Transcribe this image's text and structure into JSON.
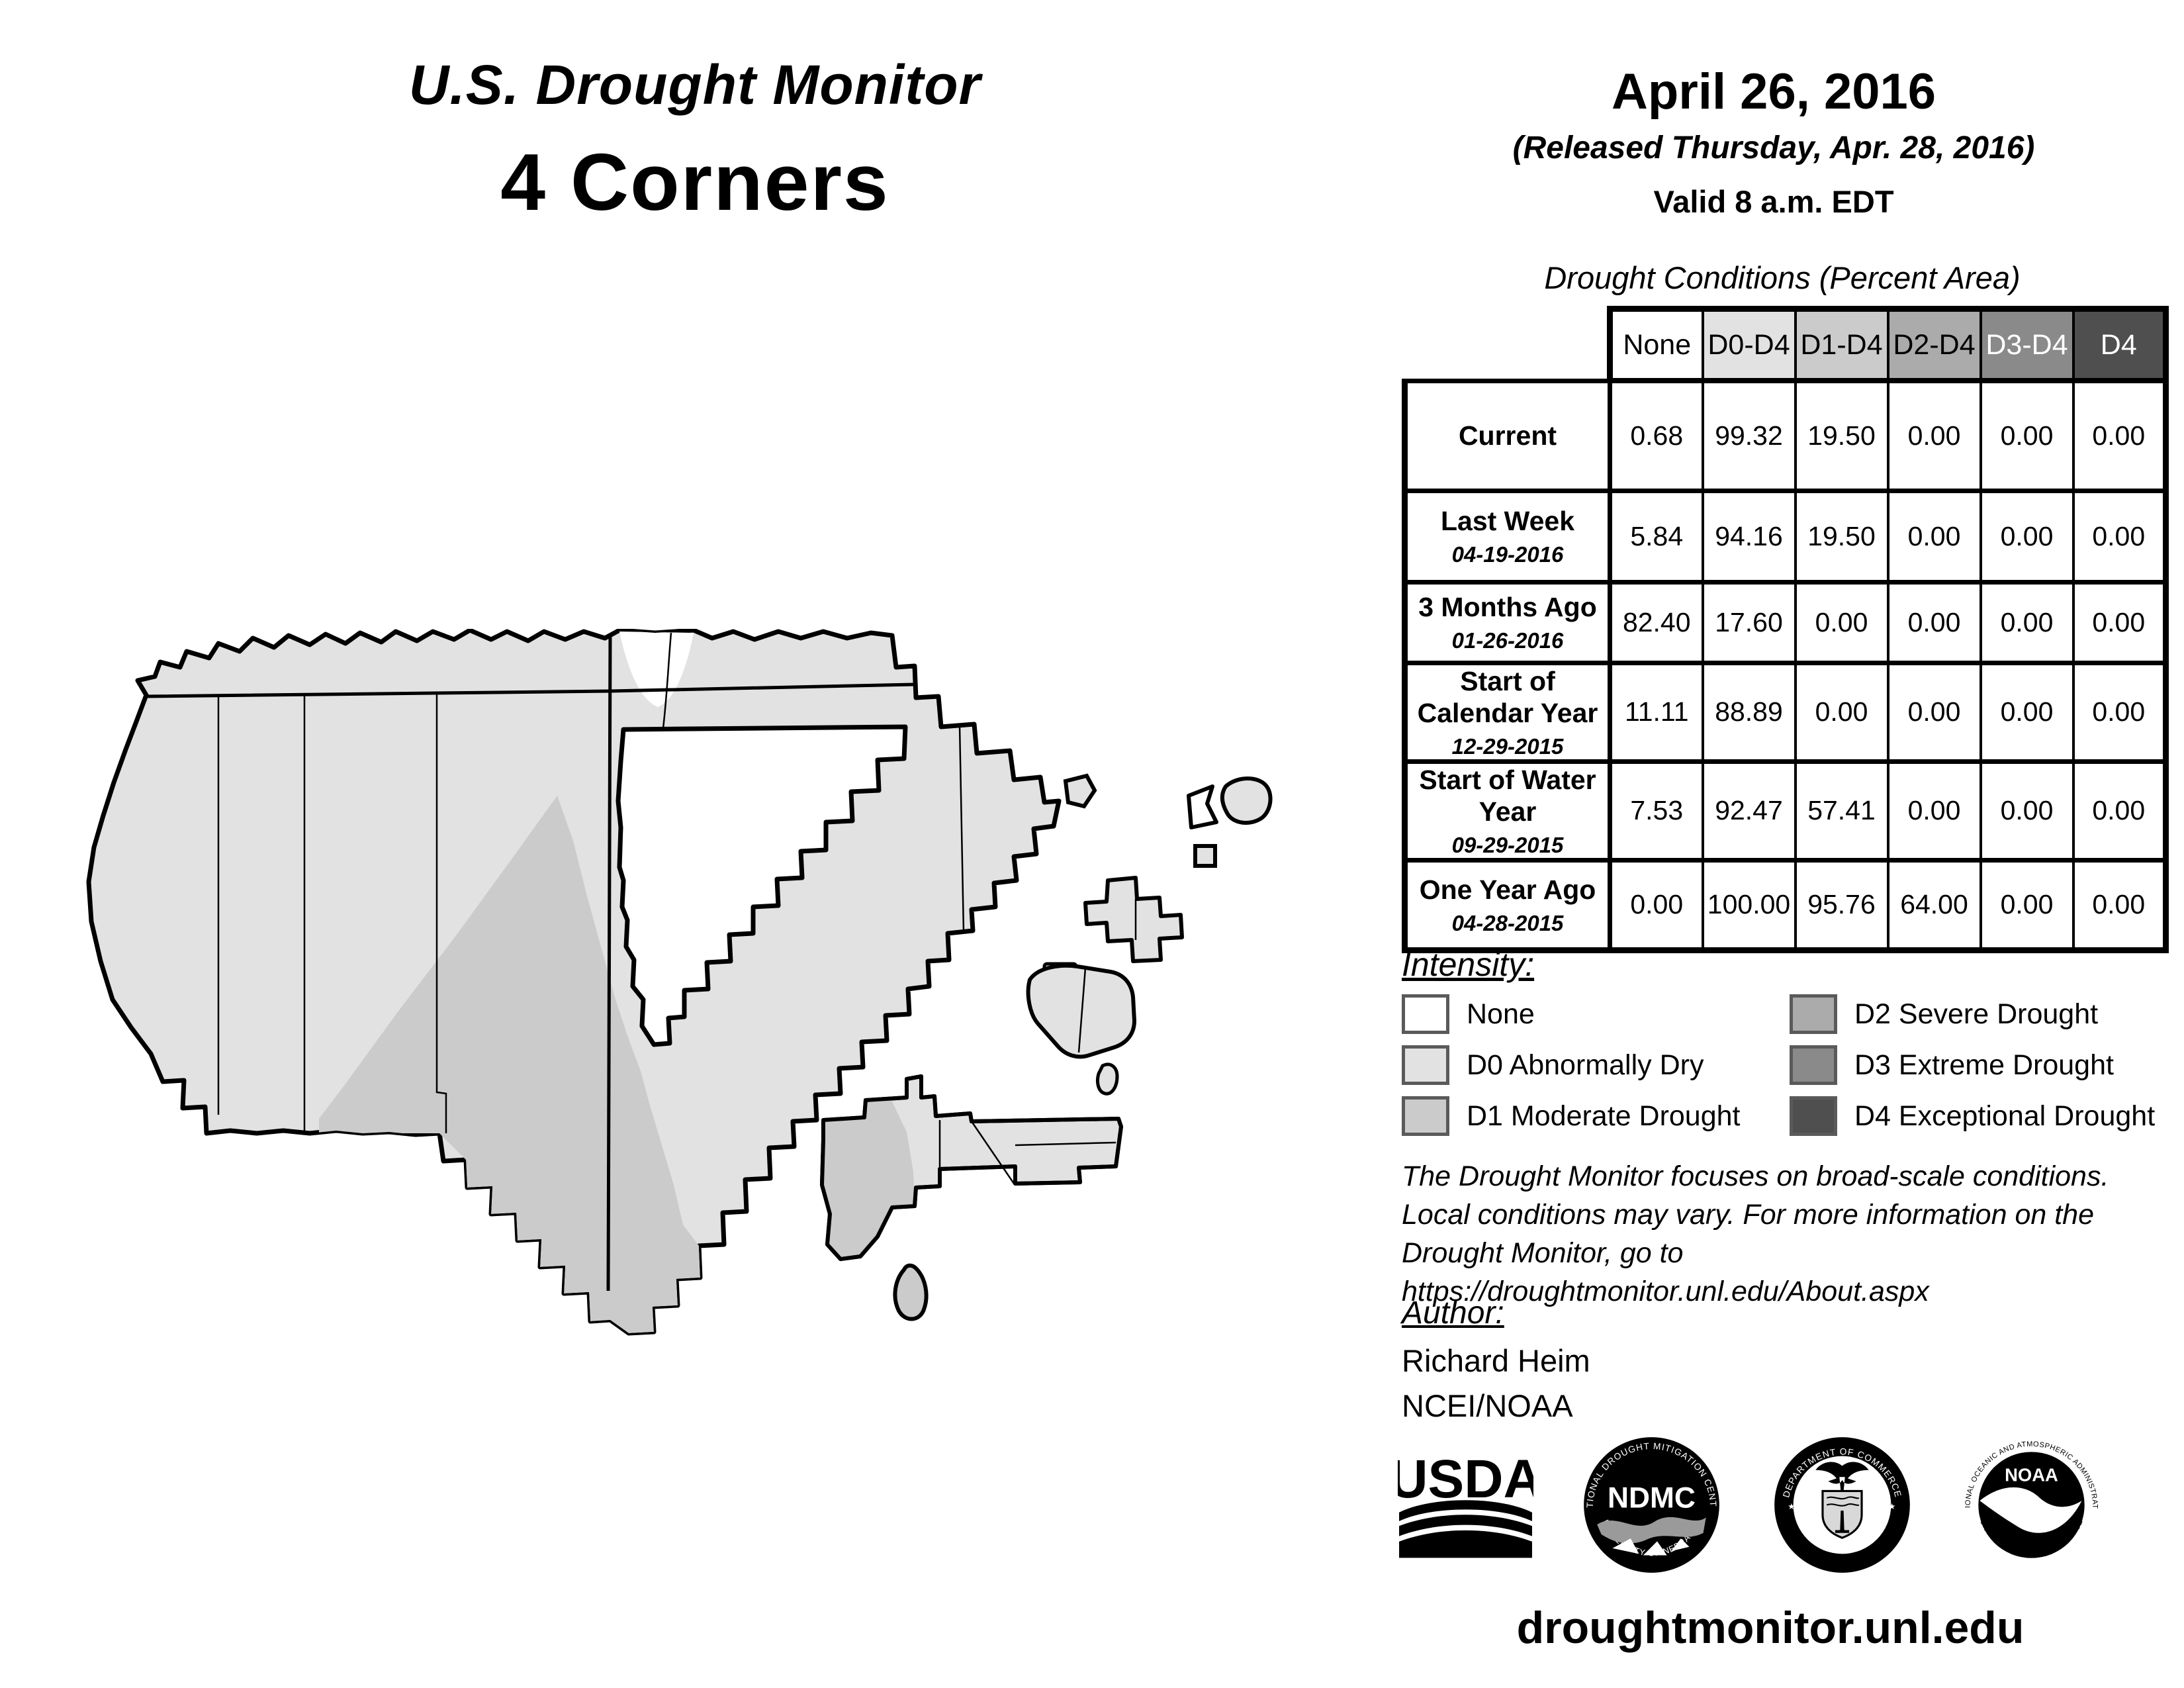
{
  "header": {
    "title": "U.S. Drought Monitor",
    "region": "4 Corners",
    "date": "April 26, 2016",
    "released": "(Released Thursday, Apr. 28, 2016)",
    "valid": "Valid 8 a.m. EDT"
  },
  "table": {
    "title": "Drought Conditions (Percent Area)",
    "columns": [
      "None",
      "D0-D4",
      "D1-D4",
      "D2-D4",
      "D3-D4",
      "D4"
    ],
    "column_colors": [
      "#ffffff",
      "#e2e2e2",
      "#cbcbcb",
      "#ababab",
      "#8a8a8a",
      "#4f4f4f"
    ],
    "rows": [
      {
        "label": "Current",
        "date": "",
        "values": [
          "0.68",
          "99.32",
          "19.50",
          "0.00",
          "0.00",
          "0.00"
        ]
      },
      {
        "label": "Last Week",
        "date": "04-19-2016",
        "values": [
          "5.84",
          "94.16",
          "19.50",
          "0.00",
          "0.00",
          "0.00"
        ]
      },
      {
        "label": "3 Months Ago",
        "date": "01-26-2016",
        "values": [
          "82.40",
          "17.60",
          "0.00",
          "0.00",
          "0.00",
          "0.00"
        ]
      },
      {
        "label": "Start of Calendar Year",
        "date": "12-29-2015",
        "values": [
          "11.11",
          "88.89",
          "0.00",
          "0.00",
          "0.00",
          "0.00"
        ]
      },
      {
        "label": "Start of Water Year",
        "date": "09-29-2015",
        "values": [
          "7.53",
          "92.47",
          "57.41",
          "0.00",
          "0.00",
          "0.00"
        ]
      },
      {
        "label": "One Year Ago",
        "date": "04-28-2015",
        "values": [
          "0.00",
          "100.00",
          "95.76",
          "64.00",
          "0.00",
          "0.00"
        ]
      }
    ]
  },
  "legend": {
    "title": "Intensity:",
    "items": [
      {
        "label": "None",
        "color": "#ffffff"
      },
      {
        "label": "D0 Abnormally Dry",
        "color": "#e2e2e2"
      },
      {
        "label": "D1 Moderate Drought",
        "color": "#cbcbcb"
      },
      {
        "label": "D2 Severe Drought",
        "color": "#ababab"
      },
      {
        "label": "D3 Extreme Drought",
        "color": "#8a8a8a"
      },
      {
        "label": "D4 Exceptional Drought",
        "color": "#4f4f4f"
      }
    ]
  },
  "disclaimer": {
    "line1": "The Drought Monitor focuses on broad-scale conditions.",
    "line2": "Local conditions may vary. For more information on the",
    "line3": "Drought Monitor, go to https://droughtmonitor.unl.edu/About.aspx"
  },
  "author": {
    "title": "Author:",
    "name": "Richard Heim",
    "org": "NCEI/NOAA"
  },
  "logos": {
    "usda": {
      "text": "USDA"
    },
    "ndmc": {
      "center": "NDMC",
      "top": "NATIONAL DROUGHT MITIGATION CENTER",
      "bottom": "UNIVERSITY OF NEBRASKA"
    },
    "doc": {
      "top": "DEPARTMENT OF COMMERCE",
      "bottom": "UNITED STATES OF AMERICA"
    },
    "noaa": {
      "center": "NOAA",
      "top": "NATIONAL OCEANIC AND ATMOSPHERIC ADMINISTRATION",
      "bottom": "U.S. DEPARTMENT OF COMMERCE"
    }
  },
  "footer_url": "droughtmonitor.unl.edu",
  "map": {
    "colors": {
      "none": "#ffffff",
      "d0": "#e2e2e2",
      "d1": "#cbcbcb",
      "border": "#000000"
    }
  },
  "chart_data": {
    "type": "table",
    "title": "Drought Conditions (Percent Area)",
    "region": "4 Corners",
    "valid_date": "April 26, 2016",
    "columns": [
      "None",
      "D0-D4",
      "D1-D4",
      "D2-D4",
      "D3-D4",
      "D4"
    ],
    "rows": [
      {
        "period": "Current",
        "date": "",
        "values": [
          0.68,
          99.32,
          19.5,
          0.0,
          0.0,
          0.0
        ]
      },
      {
        "period": "Last Week",
        "date": "04-19-2016",
        "values": [
          5.84,
          94.16,
          19.5,
          0.0,
          0.0,
          0.0
        ]
      },
      {
        "period": "3 Months Ago",
        "date": "01-26-2016",
        "values": [
          82.4,
          17.6,
          0.0,
          0.0,
          0.0,
          0.0
        ]
      },
      {
        "period": "Start of Calendar Year",
        "date": "12-29-2015",
        "values": [
          11.11,
          88.89,
          0.0,
          0.0,
          0.0,
          0.0
        ]
      },
      {
        "period": "Start of Water Year",
        "date": "09-29-2015",
        "values": [
          7.53,
          92.47,
          57.41,
          0.0,
          0.0,
          0.0
        ]
      },
      {
        "period": "One Year Ago",
        "date": "04-28-2015",
        "values": [
          0.0,
          100.0,
          95.76,
          64.0,
          0.0,
          0.0
        ]
      }
    ],
    "map_note": "Region map shaded mostly D0 Abnormally Dry with D1 Moderate Drought in south-central area and a small None pocket at top center"
  }
}
